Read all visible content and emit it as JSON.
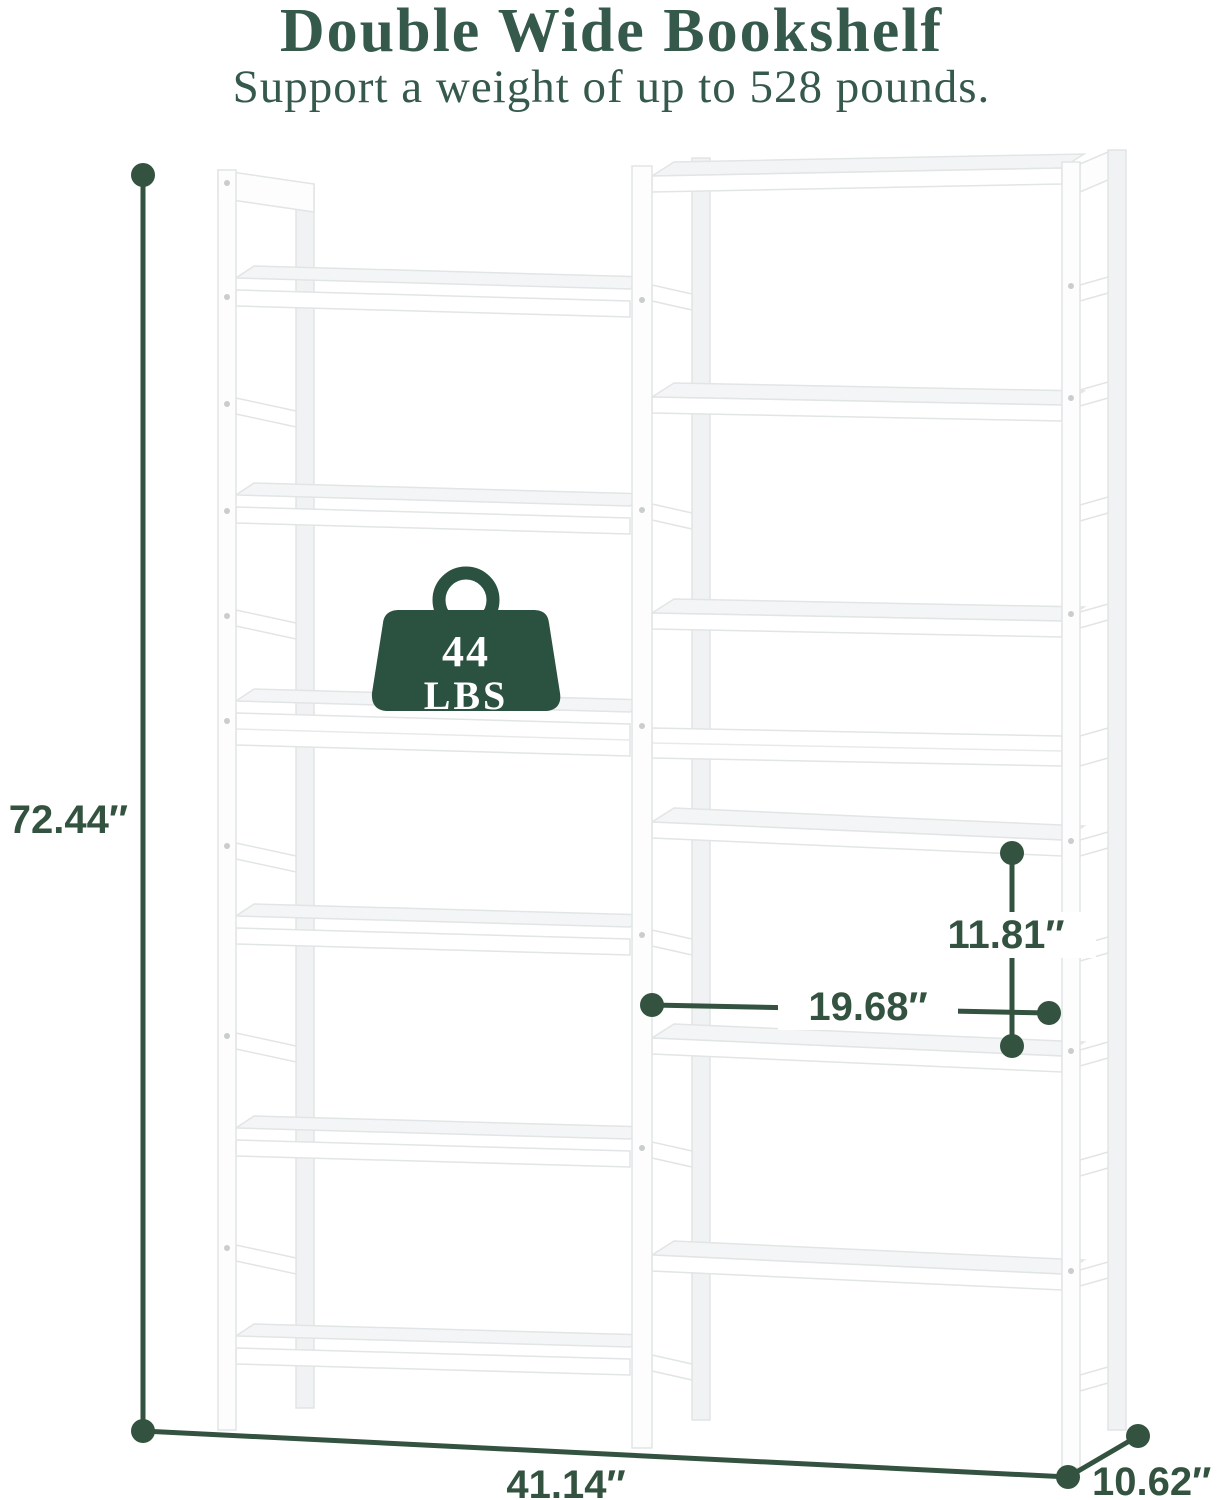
{
  "header": {
    "title": "Double Wide Bookshelf",
    "subtitle": "Support a weight of up to 528 pounds."
  },
  "weight_badge": {
    "value": "44",
    "unit": "LBS"
  },
  "dimensions": {
    "height": "72.44″",
    "width": "41.14″",
    "depth": "10.62″",
    "shelf_spacing": "11.81″",
    "inner_width": "19.68″"
  },
  "colors": {
    "heading_green": "#35594a",
    "dimension_green": "#33523f",
    "badge_green": "#2b5140"
  }
}
